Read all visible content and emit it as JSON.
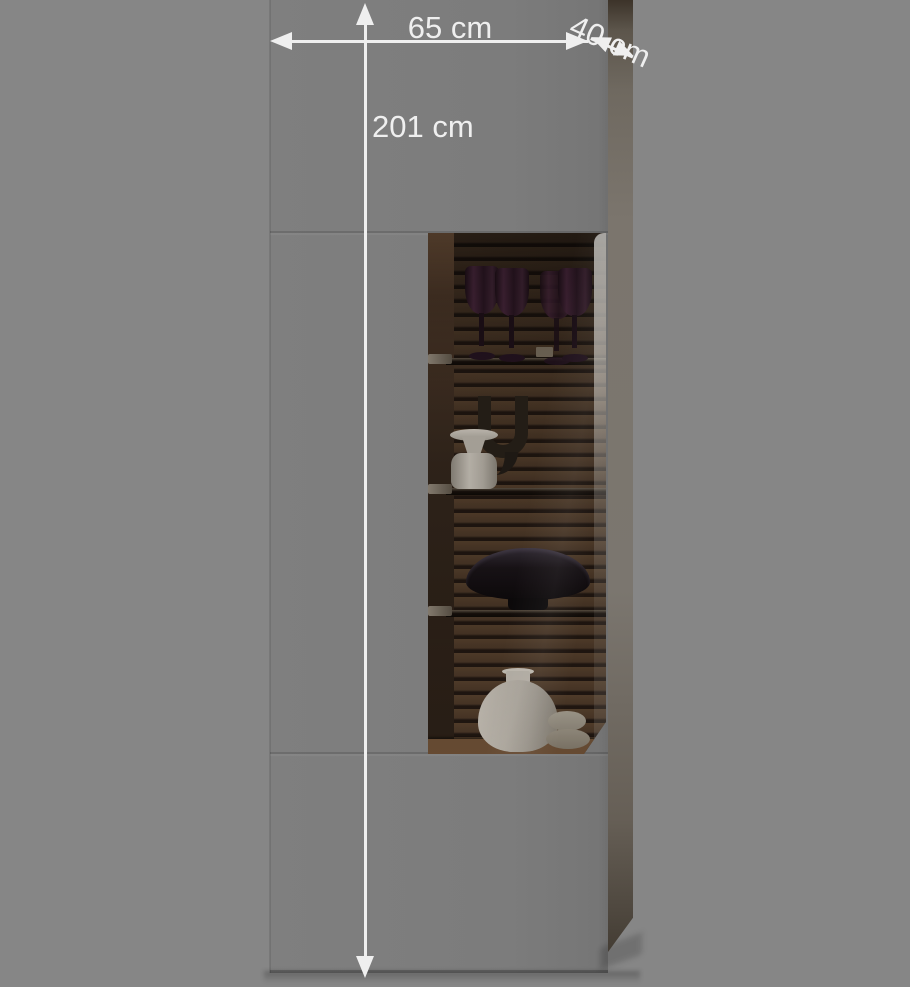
{
  "annotations": {
    "width": {
      "label": "65 cm"
    },
    "height": {
      "label": "201 cm"
    },
    "depth": {
      "label": "40 cm"
    }
  },
  "colors": {
    "bg": "#868686",
    "front": "#7d7d7d",
    "side": "#78726a",
    "ann": "#efefef",
    "slat": "#4a3727",
    "gap": "#231911",
    "glassware": "#3c2330",
    "ceramic": "#bcb6ac"
  }
}
